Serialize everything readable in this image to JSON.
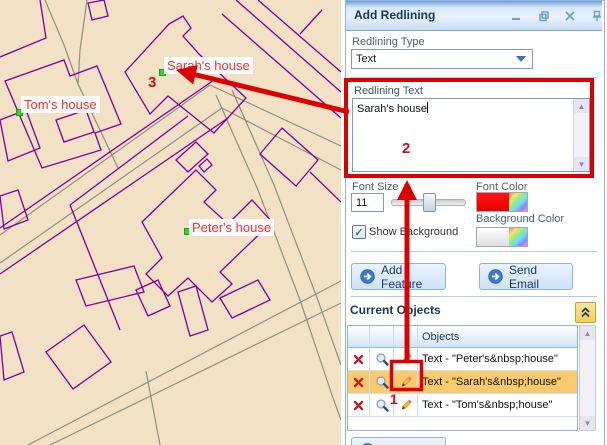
{
  "map": {
    "labels": [
      {
        "text": "Sarah's house"
      },
      {
        "text": "Tom's house"
      },
      {
        "text": "Peter's house"
      }
    ],
    "colors": {
      "background": "#f2e1c4",
      "parcel": "#7a00a2",
      "road": "#8f8f7e",
      "label_text": "#f43030",
      "marker": "#2ed52e"
    }
  },
  "annotations": {
    "step1": "1",
    "step2": "2",
    "step3": "3",
    "color": "#dd0000"
  },
  "panel": {
    "title": "Add Redlining",
    "window_controls": [
      "minimize",
      "restore",
      "close",
      "pin"
    ],
    "redlining_type": {
      "label": "Redlining Type",
      "value": "Text"
    },
    "redlining_text": {
      "label": "Redlining Text",
      "value": "Sarah's house"
    },
    "font_size": {
      "label": "Font Size",
      "value": "11"
    },
    "font_color": {
      "label": "Font Color",
      "swatch": "#fb0a0a"
    },
    "background_color": {
      "label": "Background Color"
    },
    "show_background": {
      "label": "Show Background",
      "checked": true
    },
    "buttons": {
      "add_feature": "Add Feature",
      "send_email": "Send Email"
    },
    "current_objects": {
      "title": "Current Objects",
      "column_header": "Objects",
      "rows": [
        {
          "label": "Text - \"Peter's&nbsp;house\"",
          "selected": false
        },
        {
          "label": "Text - \"Sarah's&nbsp;house\"",
          "selected": true
        },
        {
          "label": "Text - \"Tom's&nbsp;house\"",
          "selected": false
        }
      ]
    }
  }
}
